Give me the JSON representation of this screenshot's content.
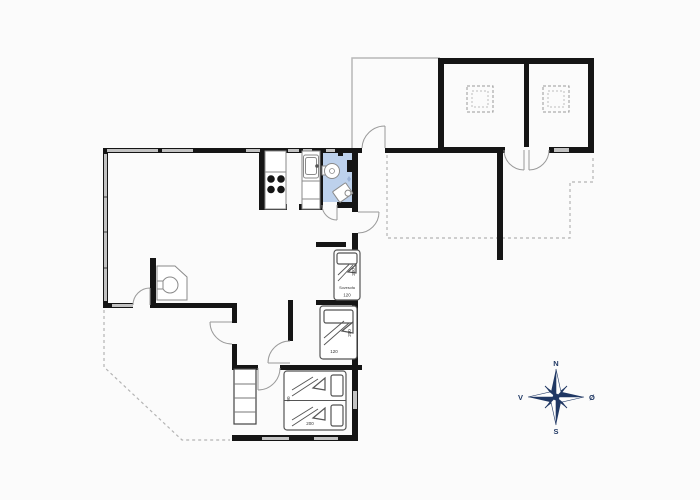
{
  "floorplan": {
    "labels": {
      "sovesofa": {
        "name": "Sovesofa",
        "length": "200",
        "width": "120"
      },
      "bed_middle": {
        "length": "200",
        "width": "120"
      },
      "bed_double": {
        "length": "200",
        "width": "90"
      }
    },
    "compass": {
      "n": "N",
      "s": "S",
      "e": "Ø",
      "w": "V"
    },
    "colors": {
      "wall": "#151515",
      "window": "#c2c2c2",
      "bathroom_floor": "#bdd1ec",
      "compass": "#203864",
      "terrace_dash": "#b4b4b4"
    }
  }
}
